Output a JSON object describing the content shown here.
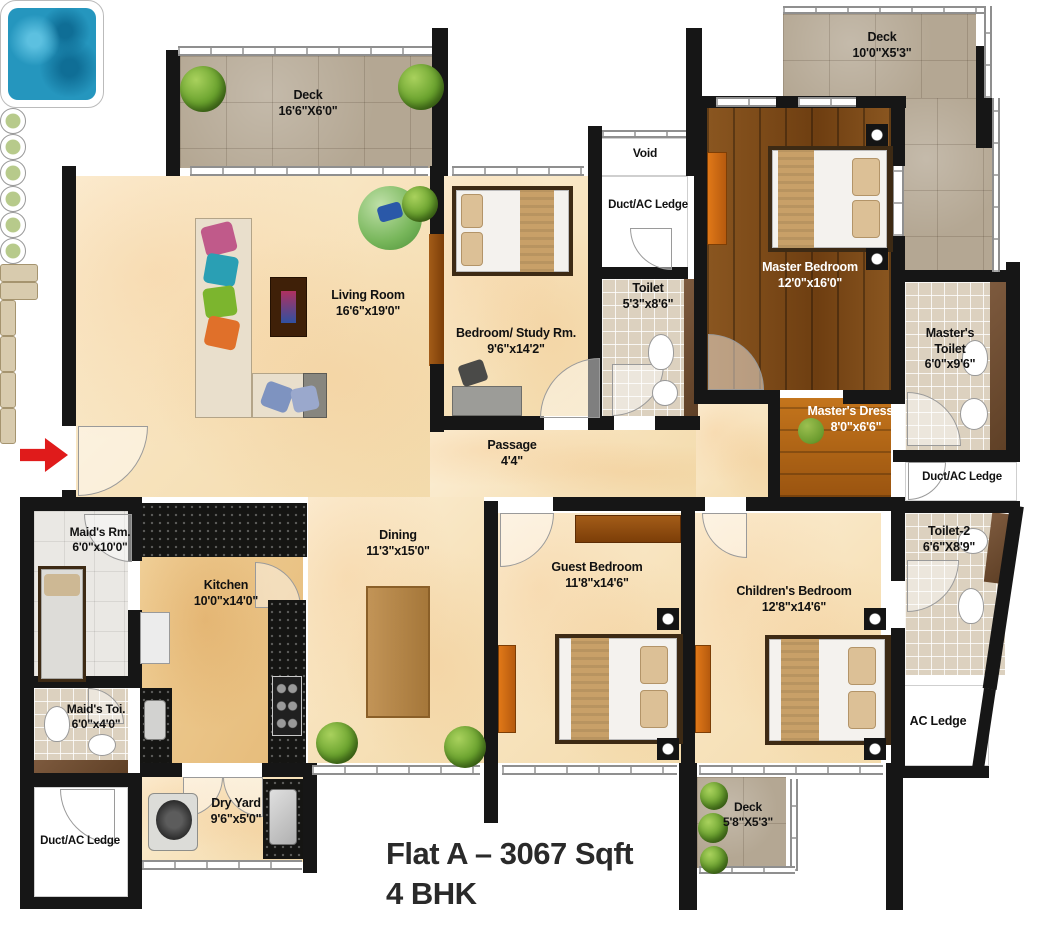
{
  "title": {
    "line1": "Flat A – 3067 Sqft",
    "line2": "4 BHK"
  },
  "rooms": {
    "deck_tl": {
      "name": "Deck",
      "dims": "16'6\"X6'0\""
    },
    "living": {
      "name": "Living Room",
      "dims": "16'6\"x19'0\""
    },
    "bedroom_study": {
      "name": "Bedroom/ Study Rm.",
      "dims": "9'6\"x14'2\""
    },
    "void": {
      "name": "Void"
    },
    "duct_top": {
      "name": "Duct/AC Ledge"
    },
    "toilet1": {
      "name": "Toilet",
      "dims": "5'3\"x8'6\""
    },
    "passage": {
      "name": "Passage",
      "dims": "4'4\""
    },
    "master_bedroom": {
      "name": "Master Bedroom",
      "dims": "12'0\"x16'0\""
    },
    "deck_tr": {
      "name": "Deck",
      "dims": "10'0\"X5'3\""
    },
    "masters_toilet": {
      "name": "Master's Toilet",
      "dims": "6'0\"x9'6\""
    },
    "masters_dresser": {
      "name": "Master's Dresser",
      "dims": "8'0\"x6'6\""
    },
    "duct_right": {
      "name": "Duct/AC Ledge"
    },
    "toilet2": {
      "name": "Toilet-2",
      "dims": "6'6\"X8'9\""
    },
    "ac_ledge": {
      "name": "AC Ledge"
    },
    "children_bedroom": {
      "name": "Children's Bedroom",
      "dims": "12'8\"x14'6\""
    },
    "guest_bedroom": {
      "name": "Guest Bedroom",
      "dims": "11'8\"x14'6\""
    },
    "dining": {
      "name": "Dining",
      "dims": "11'3\"x15'0\""
    },
    "kitchen": {
      "name": "Kitchen",
      "dims": "10'0\"x14'0\""
    },
    "maids_room": {
      "name": "Maid's Rm.",
      "dims": "6'0\"x10'0\""
    },
    "maids_toilet": {
      "name": "Maid's Toi.",
      "dims": "6'0\"x4'0\""
    },
    "duct_bl": {
      "name": "Duct/AC Ledge"
    },
    "dry_yard": {
      "name": "Dry Yard",
      "dims": "9'6\"x5'0\""
    },
    "deck_b": {
      "name": "Deck",
      "dims": "5'8\"X5'3\""
    }
  },
  "colors": {
    "wall": "#161616",
    "floor_cream": "#f7e2bb",
    "deck_stone": "#b4a793",
    "master_wood": "#7c4a17",
    "bath_tile": "#dcd1bf",
    "jacuzzi_blue": "#2596be",
    "entrance_arrow_red": "#e01b1b",
    "label_text": "#111111",
    "title_text": "#2a2a2a"
  }
}
